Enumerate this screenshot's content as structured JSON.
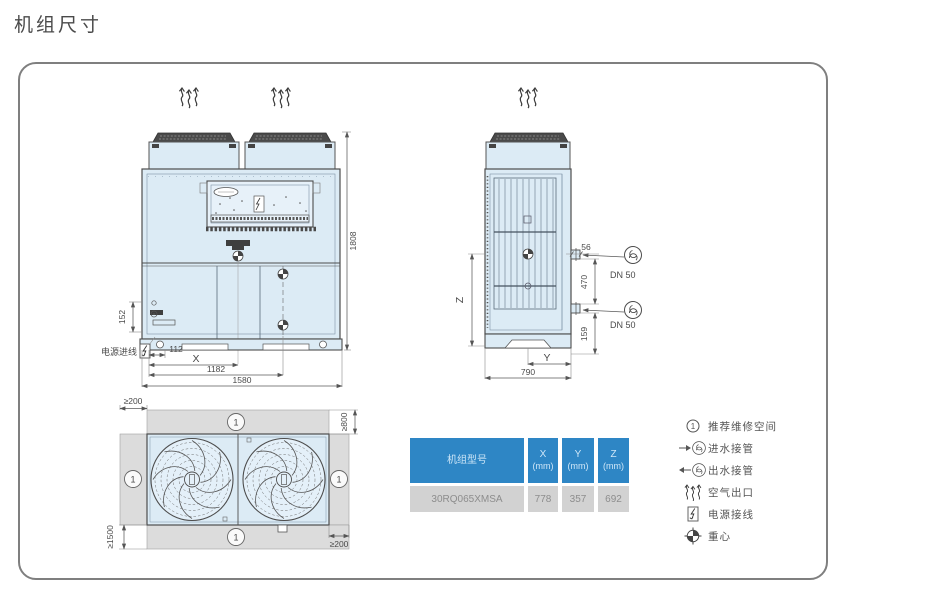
{
  "title": "机组尺寸",
  "front_view": {
    "dim_height": "1808",
    "dim_152": "152",
    "dim_112": "112",
    "dim_x_label": "X",
    "dim_1182": "1182",
    "dim_1580": "1580",
    "power_inlet_label": "电源进线"
  },
  "side_view": {
    "dim_56": "56",
    "pipe_top_label": "DN 50",
    "dim_470": "470",
    "pipe_bottom_label": "DN 50",
    "dim_159": "159",
    "dim_z_label": "Z",
    "dim_y_label": "Y",
    "dim_790": "790"
  },
  "top_view": {
    "marker": "1",
    "clearance_left": "≥200",
    "clearance_top": "≥800",
    "clearance_bottom": "≥1500",
    "clearance_right": "≥200"
  },
  "table": {
    "model_header": "机组型号",
    "columns": [
      {
        "name": "X",
        "unit": "(mm)"
      },
      {
        "name": "Y",
        "unit": "(mm)"
      },
      {
        "name": "Z",
        "unit": "(mm)"
      }
    ],
    "rows": [
      {
        "model": "30RQ065XMSA",
        "x": "778",
        "y": "357",
        "z": "692"
      }
    ]
  },
  "legend": {
    "items": [
      {
        "icon": "circled-1-icon",
        "badge": "1",
        "label": "推荐维修空间"
      },
      {
        "icon": "water-inlet-pipe-icon",
        "label": "进水接管"
      },
      {
        "icon": "water-outlet-pipe-icon",
        "label": "出水接管"
      },
      {
        "icon": "air-outlet-icon",
        "label": "空气出口"
      },
      {
        "icon": "power-wiring-icon",
        "label": "电源接线"
      },
      {
        "icon": "center-of-gravity-icon",
        "label": "重心"
      }
    ]
  },
  "colors": {
    "accent": "#2e86c5",
    "unit_fill": "#dcebf5",
    "clearance_fill": "#dcdcdc",
    "row_fill": "#d2d2d2",
    "line": "#4d4d4d"
  }
}
